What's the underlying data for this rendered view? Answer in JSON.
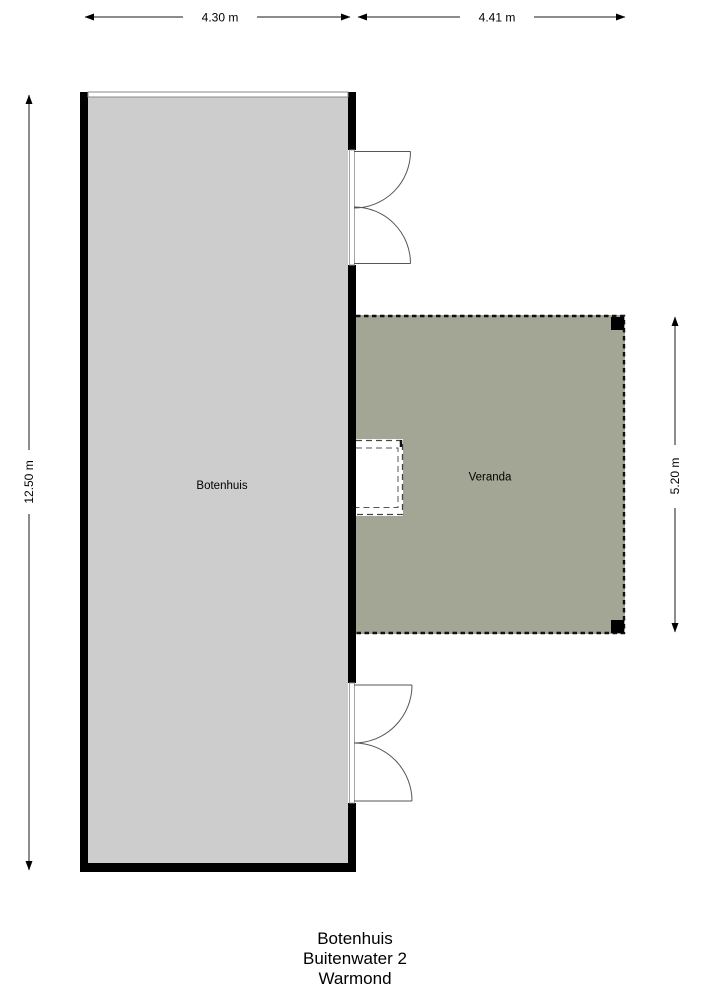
{
  "dimensions": {
    "boathouse_width": "4.30 m",
    "veranda_width": "4.41 m",
    "boathouse_height": "12.50 m",
    "veranda_height": "5.20 m"
  },
  "rooms": {
    "boathouse": "Botenhuis",
    "veranda": "Veranda"
  },
  "footer": {
    "line1": "Botenhuis",
    "line2": "Buitenwater 2",
    "line3": "Warmond"
  },
  "colors": {
    "background": "#ffffff",
    "wall": "#000000",
    "boathouse_floor": "#cdcdcd",
    "veranda_floor": "#a4a695",
    "dimension_line": "#1a1a1a",
    "door_line": "#555555"
  }
}
